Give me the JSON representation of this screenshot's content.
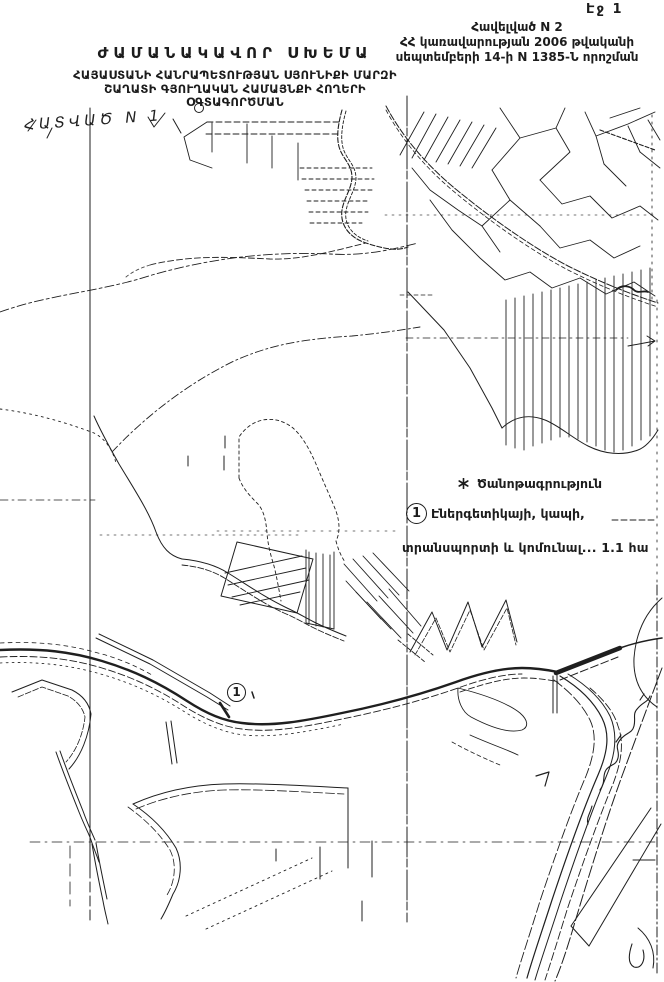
{
  "page": {
    "page_number": "Էջ 1",
    "ink_color": "#1f1f1f",
    "paper_color": "#ffffff"
  },
  "appendix": {
    "line1": "Հավելված N 2",
    "line2": "ՀՀ կառավարության 2006 թվականի",
    "line3": "սեպտեմբերի 14-ի N 1385-Ն որոշման"
  },
  "title": {
    "line1": "ԺԱՄԱՆԱԿԱՎՈՐ ՍԽԵՄԱ",
    "line2": "ՀԱՅԱՍՏԱՆԻ ՀԱՆՐԱՊԵՏՈՒԹՅԱՆ ՍՅՈՒՆԻՔԻ ՄԱՐԶԻ",
    "line3": "ՇԱՂԱՏԻ ԳՅՈՒՂԱԿԱՆ ՀԱՄԱՅՆՔԻ ՀՈՂԵՐԻ",
    "line4": "ՕԳՏԱԳՈՐԾՄԱՆ"
  },
  "section_label": "ՀԱՏՎԱԾ N 1",
  "legend": {
    "note_title": "Ծանոթագրություն",
    "item_marker_digit": "1",
    "item_line1": "Էներգետիկայի, կապի,",
    "item_line2": "տրանսպորտի և կոմունալ... 1.1  հա"
  },
  "map": {
    "marker_digit": "1"
  }
}
